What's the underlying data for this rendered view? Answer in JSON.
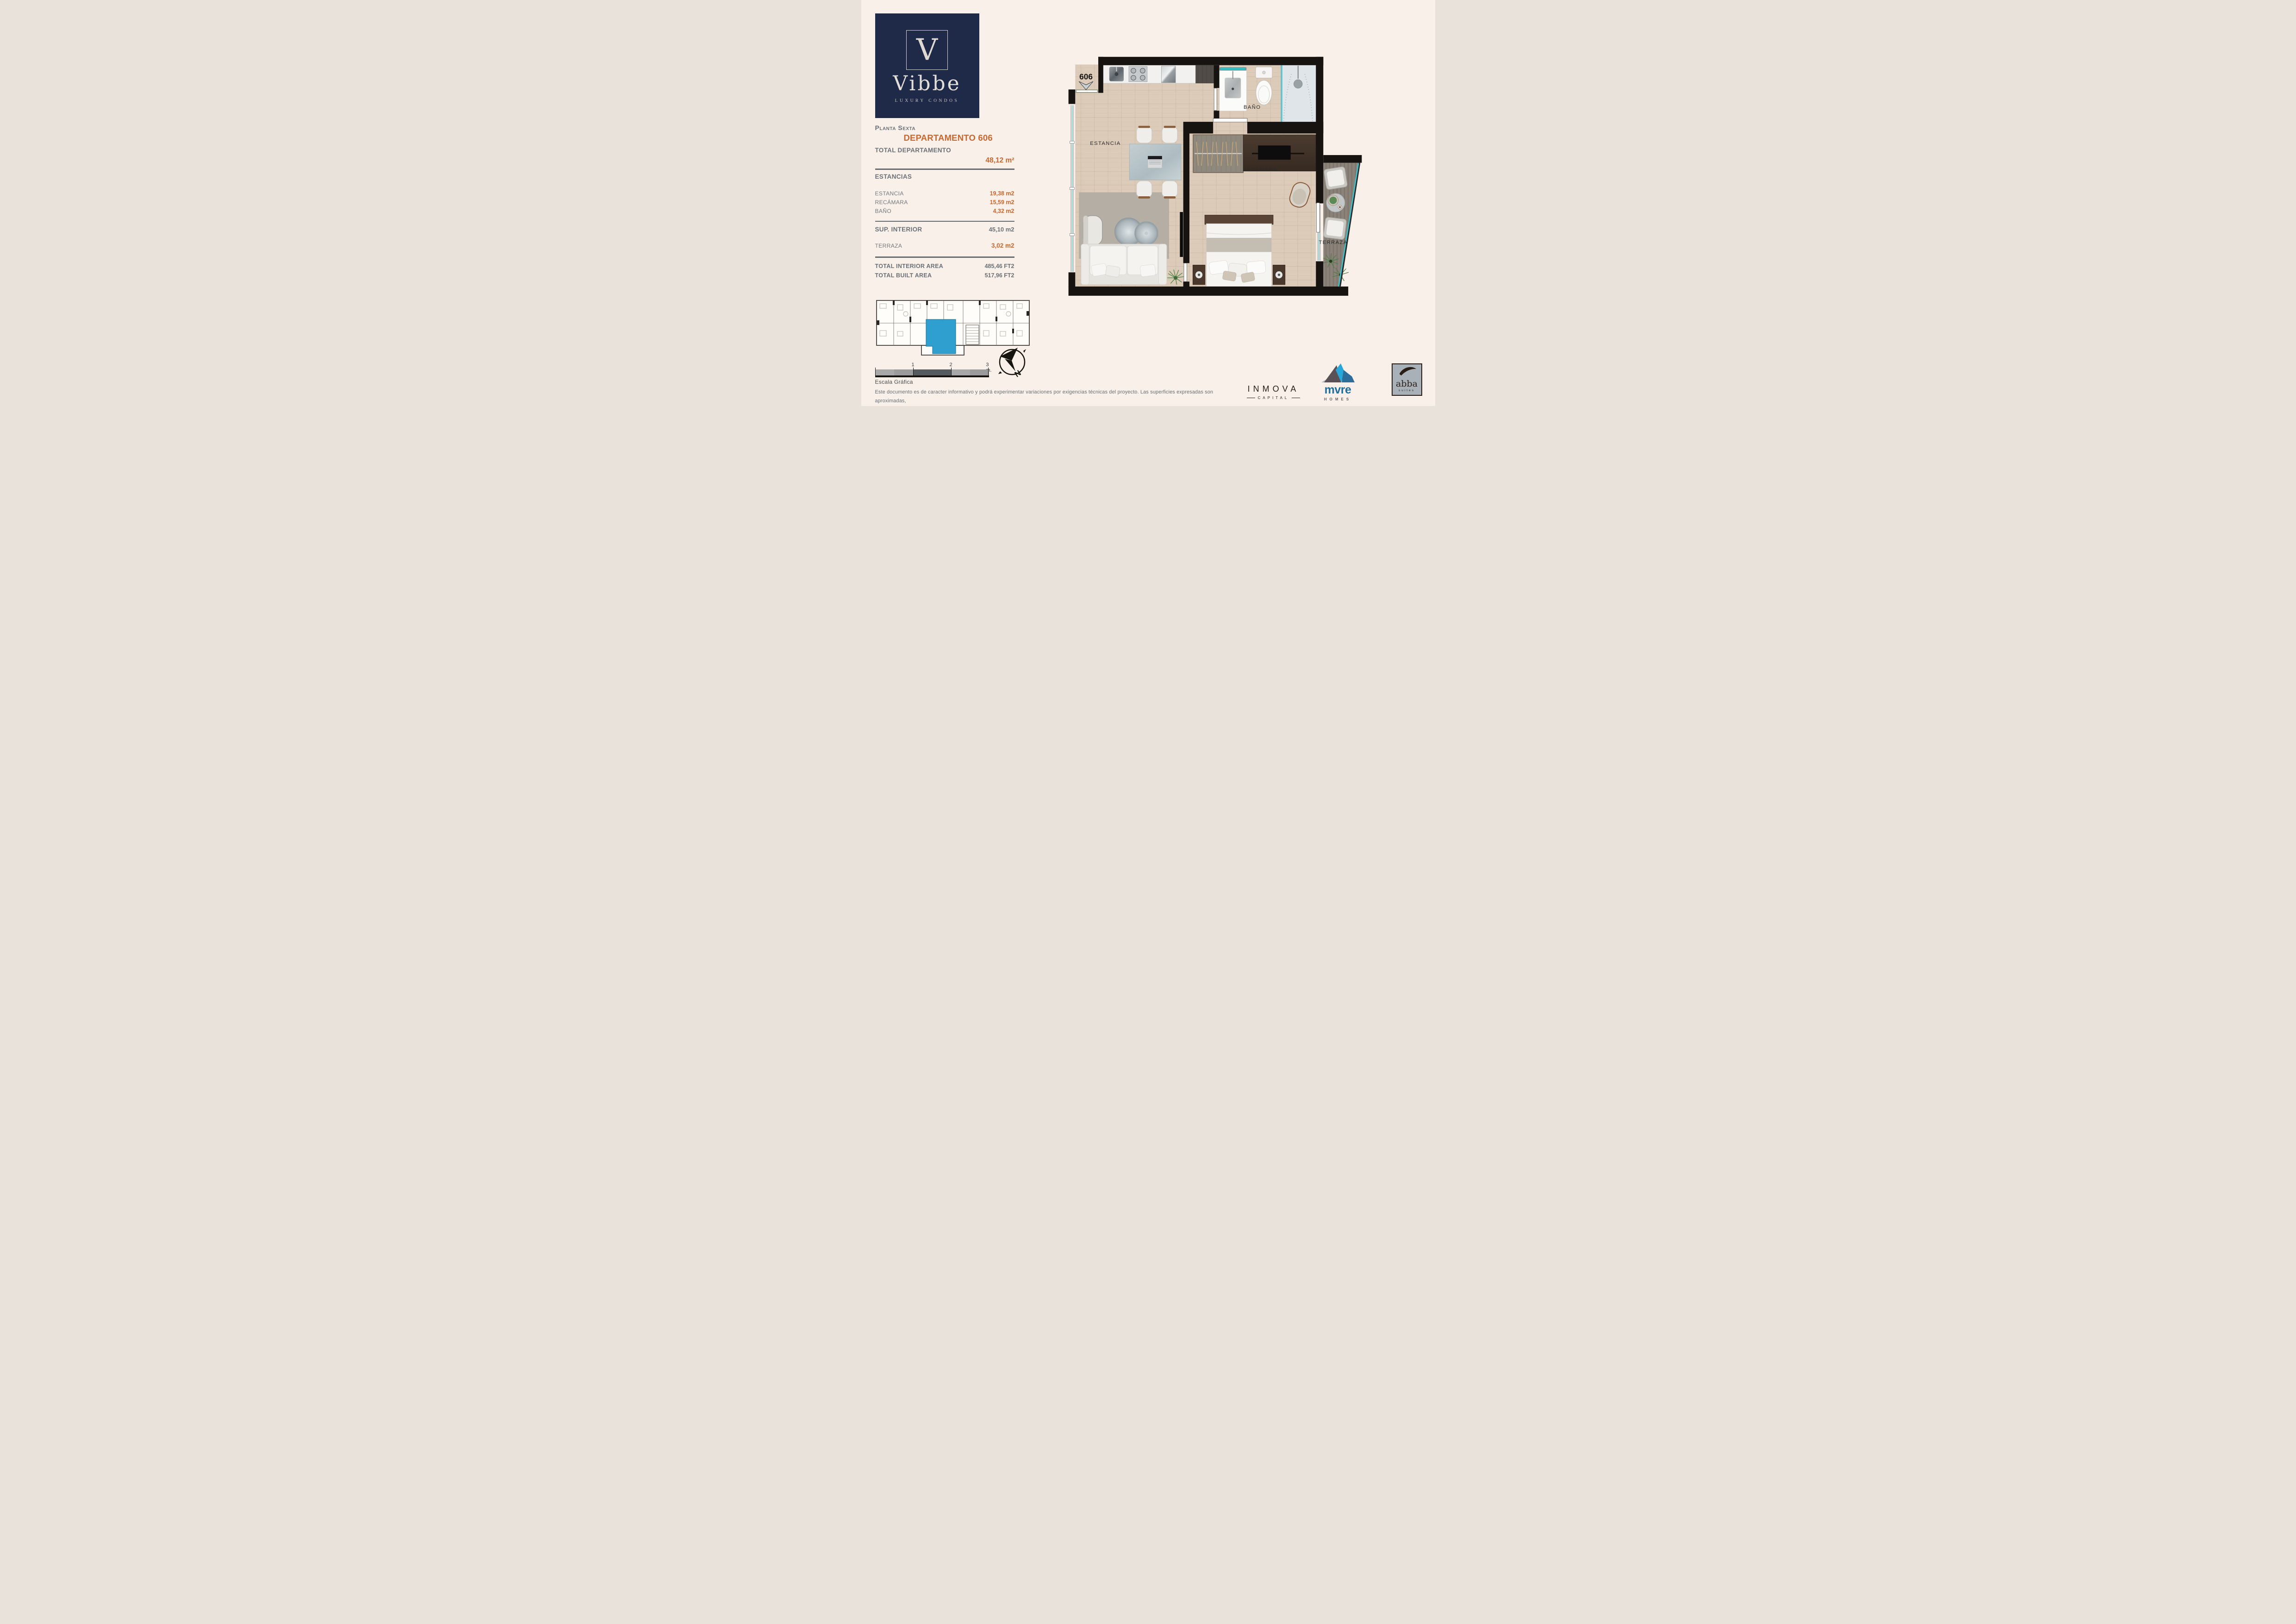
{
  "colors": {
    "accent_orange": "#c8672e",
    "navy": "#1f2a49",
    "teal_glass": "#3fc1cd",
    "unit_highlight_blue": "#2f9fd0",
    "wall_black": "#161311",
    "gray_text": "#6b7177"
  },
  "logo": {
    "monogram": "V",
    "name": "Vibbe",
    "tagline": "LUXURY CONDOS"
  },
  "info": {
    "floor_title": "Planta Sexta",
    "unit_title": "DEPARTAMENTO 606",
    "total_label": "TOTAL DEPARTAMENTO",
    "total_value": "48,12 m²",
    "sections_label": "ESTANCIAS",
    "rooms": [
      {
        "label": "ESTANCIA",
        "value": "19,38 m2"
      },
      {
        "label": "RECÁMARA",
        "value": "15,59 m2"
      },
      {
        "label": "BAÑO",
        "value": "4,32 m2"
      }
    ],
    "sup_interior": {
      "label": "SUP. INTERIOR",
      "value": "45,10 m2"
    },
    "terraza": {
      "label": "TERRAZA",
      "value": "3,02 m2"
    },
    "totals": [
      {
        "label": "TOTAL INTERIOR AREA",
        "value": "485,46 FT2"
      },
      {
        "label": "TOTAL BUILT AREA",
        "value": "517,96 FT2"
      }
    ]
  },
  "plan": {
    "unit_number": "606",
    "labels": {
      "estancia": "ESTANCIA",
      "bano": "BAÑO",
      "recamara": "RECÁMARA",
      "terraza": "TERRAZA"
    }
  },
  "scale_bar": {
    "tick1": "1",
    "tick2": "2",
    "tick3": "3 m.",
    "label": "Escala Gráfica"
  },
  "compass": {
    "north": "N"
  },
  "disclaimer": {
    "line1": "Este documento es de caracter informativo y podrá experimentar variaciones por exigencias técnicas del proyecto. Las superficies expresadas son aproximadas,",
    "line2": "podrán experimentar modificaciones por razones de dirección técnica en el desarrollo de la ejecución de la obra."
  },
  "brands": {
    "inmova": {
      "name": "INMOVA",
      "sub": "CAPITAL"
    },
    "mvre": {
      "name": "mvre",
      "sub": "HOMES"
    },
    "abba": {
      "name": "abba",
      "sub": "suites"
    }
  }
}
